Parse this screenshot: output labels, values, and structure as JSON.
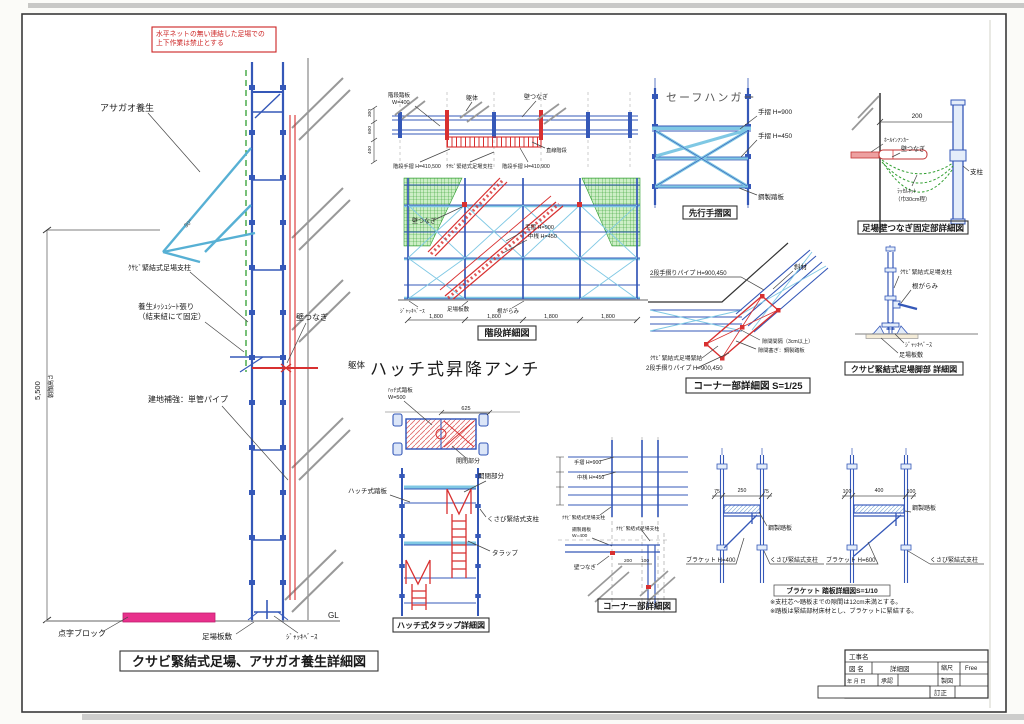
{
  "page": {
    "main_title": "クサビ緊結式足場、アサガオ養生詳細図",
    "warning": [
      "水平ネットの無い連結した足場での",
      "上下作業は禁止とする"
    ]
  },
  "left": {
    "asagao": "アサガオ養生",
    "angle": "30°",
    "post": "ｸｻﾋﾞ緊結式足場支柱",
    "mesh1": "養生ﾒｯｼｭｼｰﾄ張り",
    "mesh2": "（結束紐にて固定）",
    "walltie": "壁つなぎ",
    "kutai": "躯体",
    "hokyo": "建地補強：単管パイプ",
    "height_dim": "5,500",
    "height_label": "朝顔高さ",
    "tenji": "点字ブロック",
    "itajiki": "足場板敷",
    "jackbase": "ｼﾞｬｯｷﾍﾞｰｽ",
    "gl": "GL"
  },
  "stairs": {
    "caption": "階段詳細図",
    "top_labels": {
      "l1a": "階段踏板",
      "l1b": "W=400",
      "l2": "躯体",
      "l3": "壁つなぎ"
    },
    "mid_labels": {
      "left": "階段手摺 H=410,500",
      "center": "ｸｻﾋﾞ緊結式足場支柱",
      "right": "階段手摺 H=410,900",
      "step": "直線階段",
      "use": "使用階段"
    },
    "elev_labels": {
      "tie": "壁つなぎ",
      "tesuri": "手摺 H=900",
      "nakasan": "中桟 H=450",
      "jack": "ｼﾞｬｯｷﾍﾞｰｽ",
      "ita": "足場板敷",
      "negarami": "根がらみ"
    },
    "dims": [
      "1,800",
      "1,800",
      "1,800",
      "1,800"
    ],
    "side_dims": [
      "300",
      "600",
      "400"
    ]
  },
  "hatch": {
    "heading": "ハッチ式昇降アンチ",
    "plan": {
      "fumiita1": "ﾊｯﾁ式踏板",
      "fumiita2": "W=500",
      "dim": "625",
      "kaihei": "開閉部分"
    },
    "ladder": {
      "fumiita": "ハッチ式踏板",
      "kaihei": "開閉部分",
      "shichu": "くさび緊結式支柱",
      "tarap": "タラップ",
      "caption": "ハッチ式タラップ詳細図"
    }
  },
  "safe_hanger": {
    "title": "セーフハンガー",
    "t900": "手摺 H=900",
    "t450": "手摺 H=450",
    "fumiita": "鋼製踏板",
    "caption": "先行手摺図"
  },
  "wall_tie": {
    "dim": "200",
    "anchor": "ﾎｰﾙｲﾝｱﾝｶｰ",
    "tie": "壁つなぎ",
    "post": "支柱",
    "net1": "ﾗｯｾﾙﾈｯﾄ",
    "net2": "（巾30cm程）",
    "caption": "足場壁つなぎ固定部詳細図"
  },
  "corner25": {
    "pipe_top": "2段手摺りパイプ H=900,450",
    "shazai": "斜材",
    "gap1": "隙間間隔（3cm以上）",
    "gap2": "隙間塞ぎ：鋼製踏板",
    "kinketsu": "ｸｻﾋﾞ緊結式足場緊結",
    "pipe_bottom": "2段手摺りパイプ H=900,450",
    "caption": "コーナー部詳細図 S=1/25"
  },
  "leg": {
    "post": "ｸｻﾋﾞ緊結式足場支柱",
    "negarami": "根がらみ",
    "jack": "ｼﾞｬｯｷﾍﾞｰｽ",
    "ita": "足場板敷",
    "caption": "クサビ緊結式足場脚部 詳細図"
  },
  "corner_plan": {
    "tesuri": "手摺 H=900",
    "nakasan": "中桟 H=450",
    "shichu1": "ｸｻﾋﾞ緊結式足場支柱",
    "fumiita1": "鋼製踏板",
    "fumiita2": "W=400",
    "shichu2": "ｸｻﾋﾞ緊結式足場支柱",
    "tie": "壁つなぎ",
    "dim200": "200",
    "dim100": "100",
    "caption": "コーナー部詳細図"
  },
  "bracket": {
    "a": {
      "d1": "75",
      "d2": "250",
      "d3": "75",
      "fumiita": "鋼製踏板",
      "bracket": "ブラケット H=400",
      "shichu": "くさび緊結式支柱"
    },
    "b": {
      "d1": "100",
      "d2": "400",
      "d3": "100",
      "fumiita": "鋼製踏板",
      "bracket": "ブラケット H=600",
      "shichu": "くさび緊結式支柱"
    },
    "caption": "ブラケット 踏板詳細図S=1/10",
    "note1": "※支柱芯～踏板までの隙間は12cm未満とする。",
    "note2": "※踏板は緊結部材床材とし、ブラケットに緊結する。"
  },
  "title_block": {
    "koujimei": "工事名",
    "zumei_label": "図 名",
    "zumei_value": "詳細図",
    "shukushaku_label": "縮尺",
    "shukushaku_value": "Free",
    "date_label": "年 月 日",
    "shounin": "承認",
    "seizu": "製図",
    "teisei": "訂正"
  }
}
